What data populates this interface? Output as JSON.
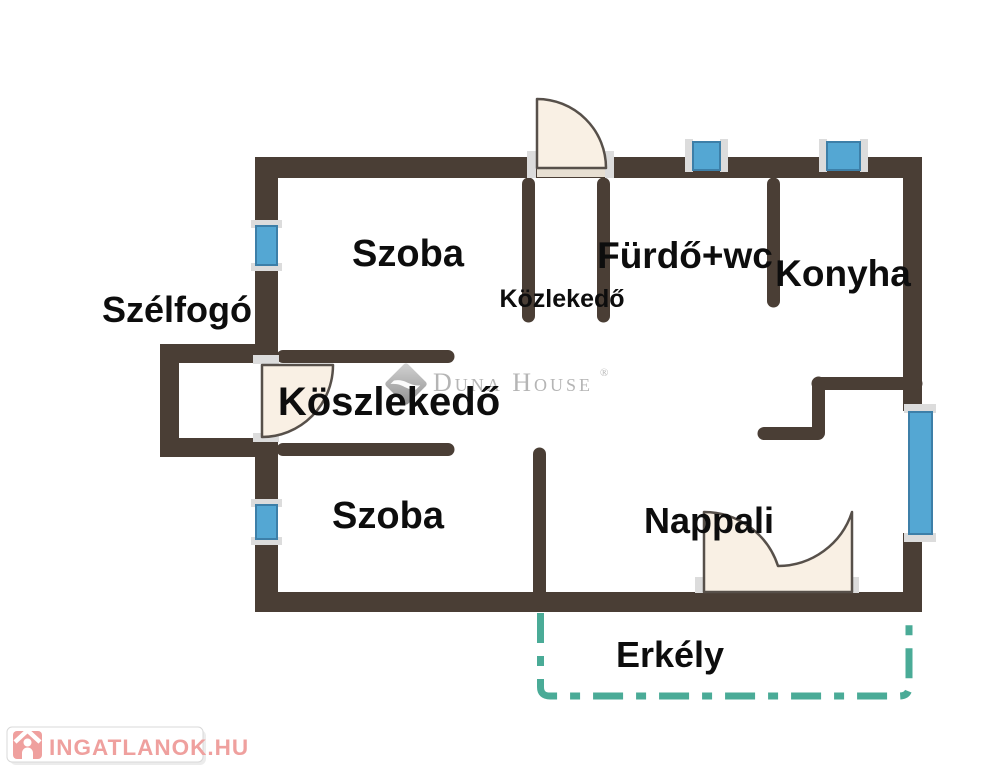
{
  "rooms": {
    "szelfogo": "Szélfogó",
    "szoba_top": "Szoba",
    "kozlekedo_small": "Közlekedő",
    "furdo_wc": "Fürdő+wc",
    "konyha": "Konyha",
    "koszlekedo": "Köszlekedő",
    "szoba_bottom": "Szoba",
    "nappali": "Nappali",
    "erkely": "Erkély"
  },
  "watermark": {
    "brand": "Duna House",
    "registered": "®"
  },
  "footer_logo": {
    "text": "INGATLANOK.HU"
  },
  "colors": {
    "wall": "#4a3e35",
    "door_fill": "#f9f0e4",
    "door_stroke": "#57504a",
    "window_fill": "#54a7d3",
    "window_stroke": "#3d7fa8",
    "fitting_gray": "#dcdcdc",
    "threshold": "#e7dfd2",
    "balcony_dash": "#4aab97",
    "label_text": "#0d0d0d",
    "watermark_gray": "#b5b5b5",
    "brand_pink": "#efa09e",
    "logo_border": "#d9d9d9",
    "logo_bg": "#ffffff"
  }
}
